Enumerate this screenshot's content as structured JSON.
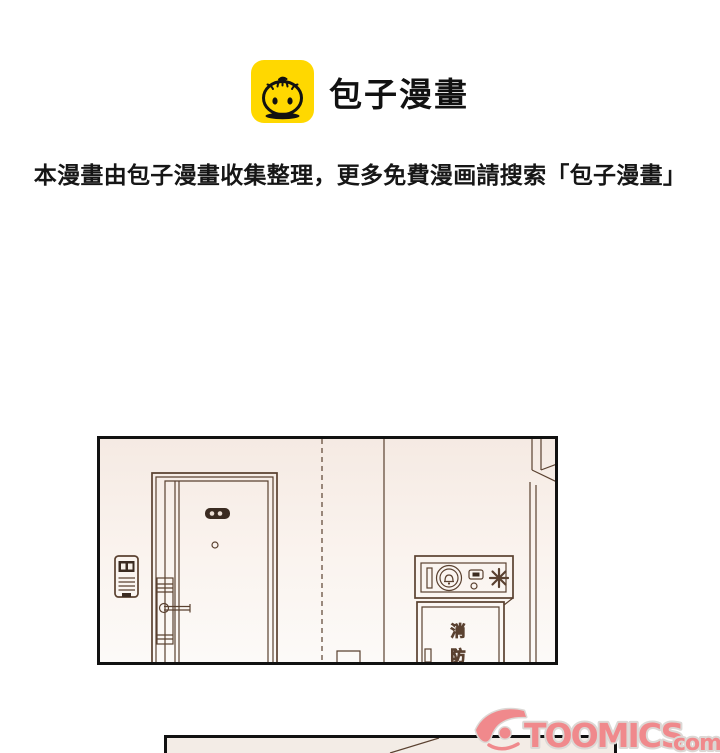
{
  "header": {
    "brand_name": "包子漫畫",
    "notice": "本漫畫由包子漫畫收集整理，更多免費漫画請搜索「包子漫畫」"
  },
  "comic": {
    "fire_cabinet_label": [
      "消",
      "防"
    ]
  },
  "watermark": {
    "brand": "TOOMICS",
    "tld": "com"
  },
  "colors": {
    "brand_yellow": "#FFD800",
    "line_art": "#5a4130",
    "panel_border": "#111111",
    "panel_bg_top": "#f5eae3",
    "panel_bg_bottom": "#fcfaf8",
    "watermark_pink": "#f0898c",
    "watermark_outline": "#dcd8d5"
  }
}
